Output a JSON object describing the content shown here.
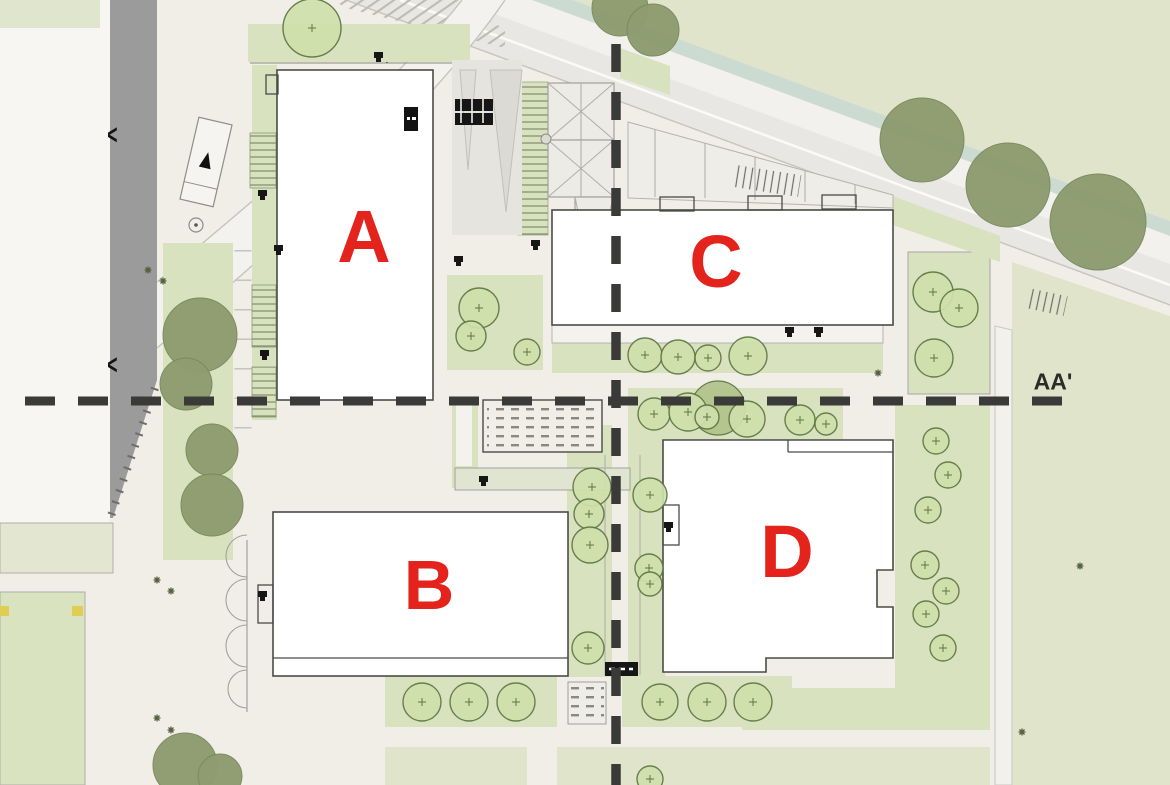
{
  "plan": {
    "type": "architectural site plan, top view",
    "building_labels": {
      "a": "A",
      "b": "B",
      "c": "C",
      "d": "D"
    },
    "section_label": "AA'",
    "road_chevron": "<",
    "colors": {
      "paper": "#f1eee8",
      "field": "#dfe4ca",
      "strip": "#d8e2bf",
      "sage": "#ccdbd2",
      "road_light": "#e9e7e3",
      "band_white": "#f2f1ed",
      "gray_road": "#9b9b9b",
      "building_fill": "#ffffff",
      "bldg_stroke": "#4b4b47",
      "line_gray": "#b3b1ab",
      "tree_light": "#cfe0ac",
      "tree_light_stroke": "#5d7742",
      "tree_dark": "#8e9c70",
      "tree_dark_stroke": "#7b8a5e",
      "tree_medium": "#b3c48e",
      "label_red": "#e3231c",
      "section_line": "#3a3a38",
      "yellow_marker": "#e0cd52",
      "icon_black": "#161616"
    },
    "trees": {
      "dark": [
        [
          620,
          8,
          28
        ],
        [
          653,
          30,
          26
        ],
        [
          922,
          140,
          42
        ],
        [
          1008,
          185,
          42
        ],
        [
          1098,
          222,
          48
        ],
        [
          200,
          335,
          37
        ],
        [
          186,
          384,
          26
        ],
        [
          212,
          450,
          26
        ],
        [
          212,
          505,
          31
        ],
        [
          185,
          765,
          32
        ],
        [
          220,
          776,
          22
        ]
      ],
      "medium": [
        [
          718,
          408,
          27
        ]
      ],
      "light": [
        [
          312,
          28,
          29
        ],
        [
          479,
          308,
          20
        ],
        [
          471,
          336,
          15
        ],
        [
          527,
          352,
          13
        ],
        [
          645,
          355,
          17
        ],
        [
          678,
          357,
          17
        ],
        [
          708,
          358,
          13
        ],
        [
          748,
          356,
          19
        ],
        [
          933,
          292,
          20
        ],
        [
          959,
          308,
          19
        ],
        [
          934,
          358,
          19
        ],
        [
          654,
          414,
          16
        ],
        [
          688,
          412,
          19
        ],
        [
          707,
          417,
          12
        ],
        [
          747,
          419,
          18
        ],
        [
          800,
          420,
          15
        ],
        [
          826,
          424,
          11
        ],
        [
          592,
          487,
          19
        ],
        [
          589,
          514,
          15
        ],
        [
          590,
          545,
          18
        ],
        [
          588,
          648,
          16
        ],
        [
          650,
          495,
          17
        ],
        [
          649,
          568,
          14
        ],
        [
          650,
          584,
          12
        ],
        [
          650,
          779,
          13
        ],
        [
          936,
          441,
          13
        ],
        [
          948,
          475,
          13
        ],
        [
          928,
          510,
          13
        ],
        [
          925,
          565,
          14
        ],
        [
          946,
          591,
          13
        ],
        [
          926,
          614,
          13
        ],
        [
          943,
          648,
          13
        ],
        [
          422,
          702,
          19
        ],
        [
          469,
          702,
          19
        ],
        [
          516,
          702,
          19
        ],
        [
          660,
          702,
          18
        ],
        [
          707,
          702,
          19
        ],
        [
          753,
          702,
          19
        ]
      ]
    },
    "entrance_markers": [
      [
        378,
        55
      ],
      [
        262,
        193
      ],
      [
        278,
        248
      ],
      [
        264,
        353
      ],
      [
        458,
        259
      ],
      [
        535,
        243
      ],
      [
        483,
        479
      ],
      [
        262,
        594
      ],
      [
        668,
        525
      ],
      [
        789,
        330
      ],
      [
        818,
        330
      ]
    ],
    "plant_marks": [
      [
        157,
        580
      ],
      [
        171,
        591
      ],
      [
        157,
        718
      ],
      [
        171,
        730
      ],
      [
        1080,
        566
      ],
      [
        1022,
        732
      ],
      [
        148,
        270
      ],
      [
        163,
        281
      ],
      [
        878,
        373
      ]
    ]
  }
}
